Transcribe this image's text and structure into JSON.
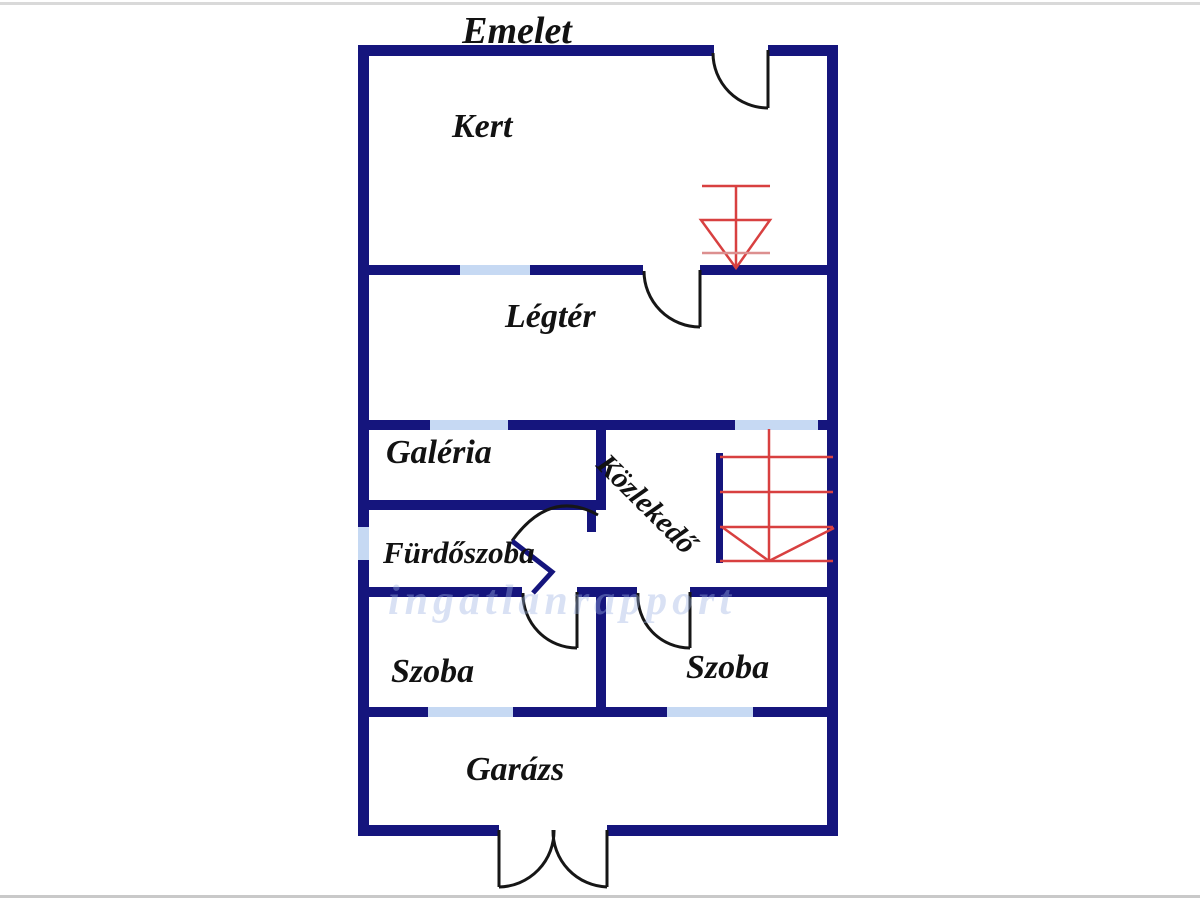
{
  "floorplan": {
    "title": "Emelet",
    "rooms": {
      "kert": "Kert",
      "legter": "Légtér",
      "galeria": "Galéria",
      "kozlekedo": "Közlekedő",
      "furdoszoba": "Fürdőszoba",
      "szoba_left": "Szoba",
      "szoba_right": "Szoba",
      "garazs": "Garázs"
    },
    "watermark_text": "ingatlanrapport",
    "colors": {
      "wall_navy": "#15157d",
      "window_blue": "#c6d9f3",
      "stair_red": "#d84040",
      "stair_red_light": "#dc8f8f",
      "door_black": "#161616",
      "label_text": "#121212"
    },
    "symbols": [
      "window-marker",
      "door-swing-arc",
      "double-door",
      "staircase",
      "stair-direction-arrow"
    ]
  }
}
